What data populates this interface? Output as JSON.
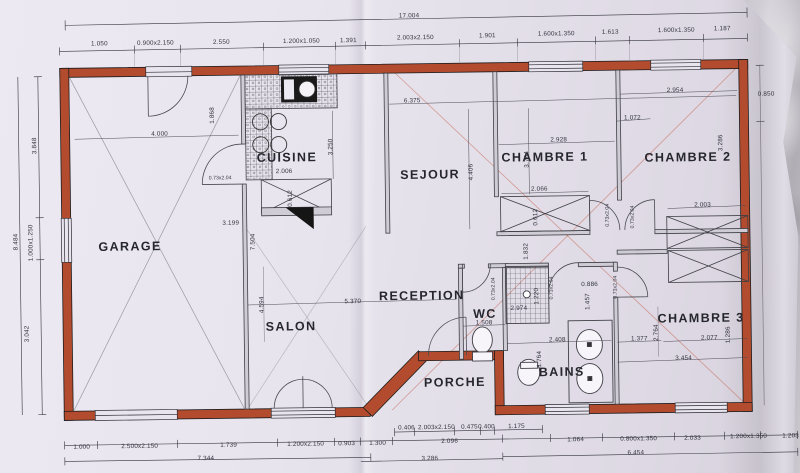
{
  "plan": {
    "colors": {
      "wall_red": "#b34c2e",
      "paper": "#e8e4ee",
      "line": "#33333d"
    },
    "rooms": [
      {
        "text": "GARAGE",
        "x": 130,
        "y": 243
      },
      {
        "text": "CUISINE",
        "x": 288,
        "y": 156
      },
      {
        "text": "SEJOUR",
        "x": 431,
        "y": 175
      },
      {
        "text": "CHAMBRE 1",
        "x": 546,
        "y": 159
      },
      {
        "text": "CHAMBRE 2",
        "x": 689,
        "y": 161
      },
      {
        "text": "SALON",
        "x": 290,
        "y": 325
      },
      {
        "text": "RECEPTION",
        "x": 421,
        "y": 296
      },
      {
        "text": "WC",
        "x": 484,
        "y": 315
      },
      {
        "text": "BAINS",
        "x": 560,
        "y": 374
      },
      {
        "text": "PORCHE",
        "x": 453,
        "y": 383
      },
      {
        "text": "CHAMBRE 3",
        "x": 700,
        "y": 322
      }
    ],
    "dims": [
      {
        "text": "17.004",
        "x": 412,
        "y": 16
      },
      {
        "text": "1.050",
        "x": 102,
        "y": 40
      },
      {
        "text": "0.900x2.150",
        "x": 158,
        "y": 40
      },
      {
        "text": "2.550",
        "x": 224,
        "y": 40
      },
      {
        "text": "1.200x1.050",
        "x": 304,
        "y": 40
      },
      {
        "text": "1.391",
        "x": 351,
        "y": 40
      },
      {
        "text": "2.003x2.150",
        "x": 418,
        "y": 38
      },
      {
        "text": "1.901",
        "x": 490,
        "y": 37
      },
      {
        "text": "1.600x1.350",
        "x": 559,
        "y": 36
      },
      {
        "text": "1.613",
        "x": 613,
        "y": 35
      },
      {
        "text": "1.600x1.350",
        "x": 679,
        "y": 34
      },
      {
        "text": "1.187",
        "x": 725,
        "y": 33
      },
      {
        "text": "8.484",
        "x": 16,
        "y": 237,
        "r": -90
      },
      {
        "text": "3.848",
        "x": 36,
        "y": 141,
        "r": -90
      },
      {
        "text": "1.000x1.250",
        "x": 31,
        "y": 238,
        "r": -90
      },
      {
        "text": "3.042",
        "x": 26,
        "y": 329,
        "r": -90
      },
      {
        "text": "0.850",
        "x": 768,
        "y": 99
      },
      {
        "text": "4.000",
        "x": 161,
        "y": 131
      },
      {
        "text": "1.868",
        "x": 214,
        "y": 113,
        "r": -90
      },
      {
        "text": "3.199",
        "x": 231,
        "y": 221
      },
      {
        "text": "7.504",
        "x": 253,
        "y": 240,
        "r": -90
      },
      {
        "text": "4.594",
        "x": 261,
        "y": 303,
        "r": -90
      },
      {
        "text": "2.006",
        "x": 285,
        "y": 170
      },
      {
        "text": "0.612",
        "x": 291,
        "y": 197,
        "r": -90
      },
      {
        "text": "6.375",
        "x": 414,
        "y": 101
      },
      {
        "text": "3.250",
        "x": 332,
        "y": 146,
        "r": -90
      },
      {
        "text": "4.406",
        "x": 472,
        "y": 173,
        "r": -90
      },
      {
        "text": "5.370",
        "x": 352,
        "y": 301
      },
      {
        "text": "2.928",
        "x": 560,
        "y": 142
      },
      {
        "text": "3.764",
        "x": 528,
        "y": 161,
        "r": -90
      },
      {
        "text": "2.954",
        "x": 677,
        "y": 94
      },
      {
        "text": "1.072",
        "x": 634,
        "y": 121
      },
      {
        "text": "3.286",
        "x": 722,
        "y": 147,
        "r": -90
      },
      {
        "text": "2.003",
        "x": 703,
        "y": 209
      },
      {
        "text": "2.066",
        "x": 540,
        "y": 191
      },
      {
        "text": "0.612",
        "x": 536,
        "y": 219,
        "r": -90
      },
      {
        "text": "1.832",
        "x": 526,
        "y": 253,
        "r": -90
      },
      {
        "text": "2.974",
        "x": 518,
        "y": 310
      },
      {
        "text": "1.220",
        "x": 536,
        "y": 298,
        "r": -90
      },
      {
        "text": "0.886",
        "x": 589,
        "y": 287
      },
      {
        "text": "1.457",
        "x": 587,
        "y": 304,
        "r": -90
      },
      {
        "text": "2.408",
        "x": 556,
        "y": 342
      },
      {
        "text": "1.377",
        "x": 638,
        "y": 342
      },
      {
        "text": "2.764",
        "x": 655,
        "y": 336,
        "r": -90
      },
      {
        "text": "2.077",
        "x": 708,
        "y": 342
      },
      {
        "text": "3.454",
        "x": 682,
        "y": 362
      },
      {
        "text": "1.764",
        "x": 538,
        "y": 361,
        "r": -90
      },
      {
        "text": "1.286",
        "x": 727,
        "y": 339,
        "r": -90
      },
      {
        "text": "1.508",
        "x": 483,
        "y": 324
      },
      {
        "text": "0.406",
        "x": 404,
        "y": 428
      },
      {
        "text": "2.003x2.150",
        "x": 434,
        "y": 428
      },
      {
        "text": "0.475",
        "x": 467,
        "y": 428
      },
      {
        "text": "0.400",
        "x": 484,
        "y": 428
      },
      {
        "text": "1.175",
        "x": 514,
        "y": 428
      },
      {
        "text": "1.000",
        "x": 79,
        "y": 443
      },
      {
        "text": "2.500x2.150",
        "x": 137,
        "y": 443
      },
      {
        "text": "1.739",
        "x": 226,
        "y": 443
      },
      {
        "text": "1.200x2.150",
        "x": 303,
        "y": 443
      },
      {
        "text": "0.903",
        "x": 344,
        "y": 443
      },
      {
        "text": "1.300",
        "x": 375,
        "y": 443
      },
      {
        "text": "2.096",
        "x": 447,
        "y": 442
      },
      {
        "text": "1.064",
        "x": 573,
        "y": 442
      },
      {
        "text": "0.800x1.350",
        "x": 636,
        "y": 442
      },
      {
        "text": "2.033",
        "x": 690,
        "y": 442
      },
      {
        "text": "1.200x1.350",
        "x": 746,
        "y": 441
      },
      {
        "text": "1.203",
        "x": 788,
        "y": 441
      },
      {
        "text": "7.344",
        "x": 203,
        "y": 456
      },
      {
        "text": "3.286",
        "x": 427,
        "y": 459
      },
      {
        "text": "6.454",
        "x": 633,
        "y": 456
      }
    ],
    "door_labels": [
      {
        "text": "0.73x2.04",
        "x": 221,
        "y": 176
      },
      {
        "text": "0.73x2.04",
        "x": 608,
        "y": 218,
        "r": -90
      },
      {
        "text": "0.73x2.04",
        "x": 633,
        "y": 220,
        "r": -90
      },
      {
        "text": "0.73x2.04",
        "x": 493,
        "y": 290,
        "r": -90
      },
      {
        "text": "0.73x2.04",
        "x": 551,
        "y": 290,
        "r": -90
      },
      {
        "text": "0.73x2.04",
        "x": 615,
        "y": 290,
        "r": -90
      }
    ]
  }
}
